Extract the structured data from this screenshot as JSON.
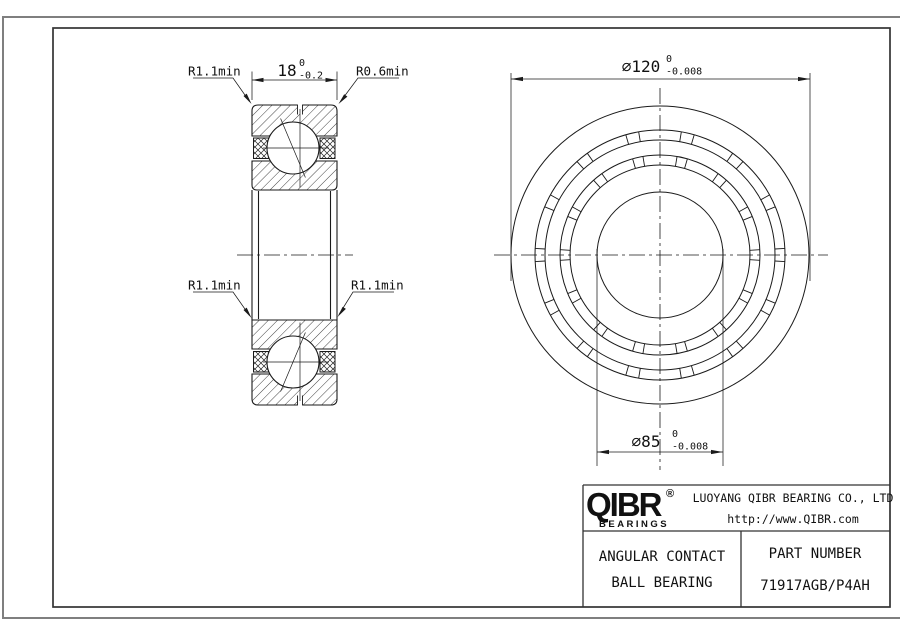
{
  "drawing": {
    "dim_width": {
      "value": "18",
      "tol_upper": "0",
      "tol_lower": "-0.2"
    },
    "dim_od": {
      "value": "∅120",
      "tol_upper": "0",
      "tol_lower": "-0.008"
    },
    "dim_bore": {
      "value": "∅85",
      "tol_upper": "0",
      "tol_lower": "-0.008"
    },
    "radius_labels": {
      "top_left": "R1.1min",
      "top_right": "R0.6min",
      "mid_left": "R1.1min",
      "mid_right": "R1.1min"
    }
  },
  "title_block": {
    "logo": "QIBR",
    "logo_reg": "®",
    "logo_sub": "BEARINGS",
    "company": "LUOYANG QIBR BEARING CO., LTD",
    "website": "http://www.QIBR.com",
    "product_line1": "ANGULAR CONTACT",
    "product_line2": "BALL BEARING",
    "part_label": "PART NUMBER",
    "part_number": "71917AGB/P4AH"
  },
  "colors": {
    "line": "#1a1a1a",
    "border_outer": "#7f7f7f",
    "border_inner": "#333333",
    "background": "#ffffff"
  }
}
